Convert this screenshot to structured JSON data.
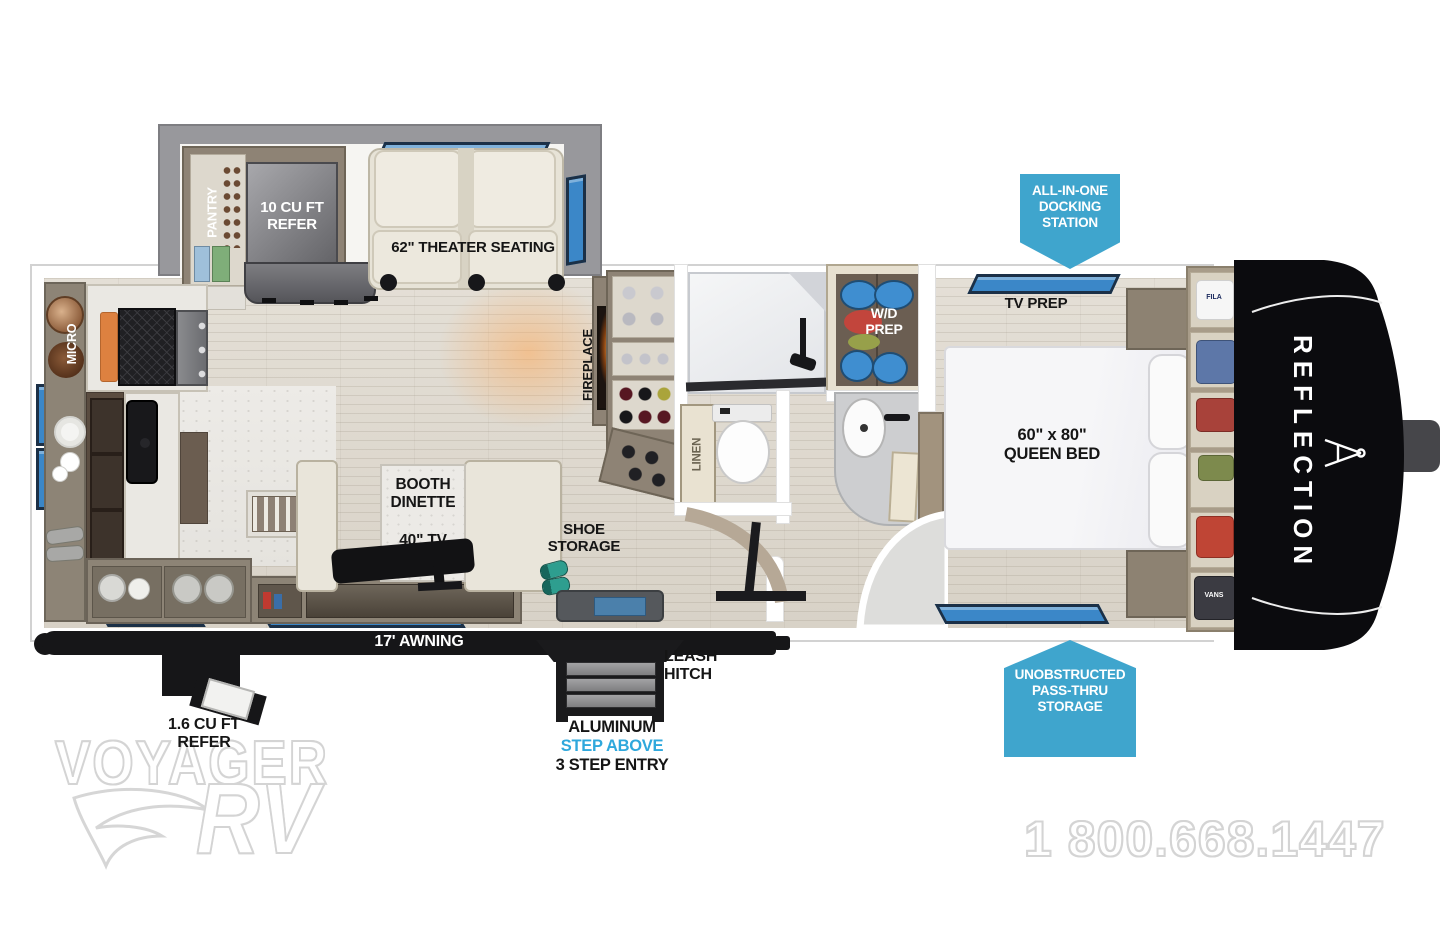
{
  "branding": {
    "model": "REFLECTION",
    "phone": "1 800.668.1447",
    "watermark_main": "VOYAGER",
    "watermark_sub": "RV"
  },
  "callouts": {
    "docking_station": "ALL-IN-ONE\nDOCKING\nSTATION",
    "pass_thru": "UNOBSTRUCTED\nPASS-THRU\nSTORAGE"
  },
  "labels": {
    "pantry": "PANTRY",
    "refer_10": "10 CU FT\nREFER",
    "theater": "62\" THEATER SEATING",
    "micro": "MICRO",
    "fireplace": "FIREPLACE",
    "booth_dinette": "BOOTH\nDINETTE",
    "tv_40": "40\" TV",
    "shoe_storage": "SHOE\nSTORAGE",
    "linen": "LINEN",
    "wd_prep": "W/D\nPREP",
    "tv_prep": "TV PREP",
    "queen_bed": "60\" x 80\"\nQUEEN BED",
    "awning": "17' AWNING",
    "leash_hitch": "LEASH\nHITCH",
    "step_material": "ALUMINUM",
    "step_above": "STEP ABOVE",
    "step_entry": "3 STEP ENTRY",
    "refer_16": "1.6 CU FT\nREFER",
    "closet_brand_top": "FILA",
    "closet_brand_bottom": "VANS"
  },
  "colors": {
    "badge_blue": "#3fa5cd",
    "step_above_blue": "#2fa8dc",
    "window_blue": "#3b87c8",
    "cap_black": "#0b0b0e",
    "awning_black": "#161618"
  }
}
